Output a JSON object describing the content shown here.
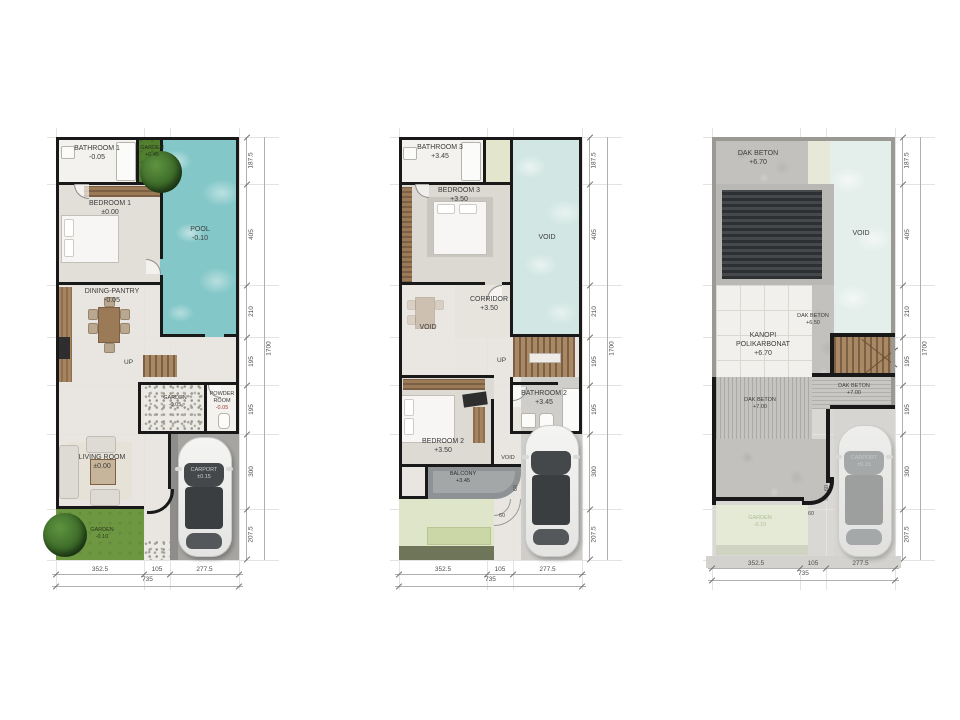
{
  "plans": [
    {
      "id": "ground-floor-plan",
      "rooms": {
        "bathroom1": {
          "name": "BATHROOM 1",
          "level": "-0.05"
        },
        "garden_top": {
          "name": "GARDEN",
          "level": "+0.45"
        },
        "pool": {
          "name": "POOL",
          "level": "-0.10"
        },
        "bedroom1": {
          "name": "BEDROOM 1",
          "level": "±0.00"
        },
        "dining": {
          "name": "DINING-PANTRY",
          "level": "-0.05"
        },
        "garden_mid": {
          "name": "GARDEN",
          "level": "-0.05"
        },
        "powder": {
          "name": "POWDER ROOM",
          "level": "-0.05"
        },
        "living": {
          "name": "LIVING ROOM",
          "level": "±0.00"
        },
        "garden_bottom": {
          "name": "GARDEN",
          "level": "-0.10"
        },
        "carport": {
          "name": "CARPORT",
          "level": "±0.15"
        }
      },
      "annotations": {
        "up": "UP"
      }
    },
    {
      "id": "second-floor-plan",
      "rooms": {
        "bathroom3": {
          "name": "BATHROOM 3",
          "level": "+3.45"
        },
        "bedroom3": {
          "name": "BEDROOM 3",
          "level": "+3.50"
        },
        "void_right": {
          "name": "VOID"
        },
        "corridor": {
          "name": "CORRIDOR",
          "level": "+3.50"
        },
        "void_left": {
          "name": "VOID"
        },
        "bathroom2": {
          "name": "BATHROOM 2",
          "level": "+3.45"
        },
        "bedroom2": {
          "name": "BEDROOM 2",
          "level": "+3.50"
        },
        "void_small": {
          "name": "VOID"
        },
        "balcony": {
          "name": "BALCONY",
          "level": "+3.45"
        }
      },
      "annotations": {
        "up": "UP",
        "dim_side": "60",
        "dim_step": "60"
      }
    },
    {
      "id": "roof-plan",
      "rooms": {
        "dak_top": {
          "name": "DAK BETON",
          "level": "+6.70"
        },
        "void_right": {
          "name": "VOID"
        },
        "dak_mid": {
          "name": "DAK BETON",
          "level": "+6.50"
        },
        "kanopi": {
          "name": "KANOPI POLIKARBONAT",
          "level": "+6.70"
        },
        "dak_right": {
          "name": "DAK BETON",
          "level": "+7.00"
        },
        "dak_left": {
          "name": "DAK BETON",
          "level": "+7.00"
        },
        "garden": {
          "name": "GARDEN",
          "level": "-0.10"
        },
        "carport": {
          "name": "CARPORT",
          "level": "±0.15"
        }
      },
      "annotations": {
        "dim_side": "60",
        "dim_step": "60"
      }
    }
  ],
  "dimensions": {
    "right": [
      "187.5",
      "405",
      "210",
      "195",
      "195",
      "300",
      "207.5"
    ],
    "right_total": "1700",
    "bottom": [
      "352.5",
      "105",
      "277.5"
    ],
    "bottom_total": "735"
  },
  "colors": {
    "pool_water": "#83c7c8",
    "void_water": "#d2e7e3",
    "garden_green": "#6d9741",
    "wall_black": "#191919",
    "roof_gray": "#9a9993",
    "concrete": "#c2c1bd"
  }
}
